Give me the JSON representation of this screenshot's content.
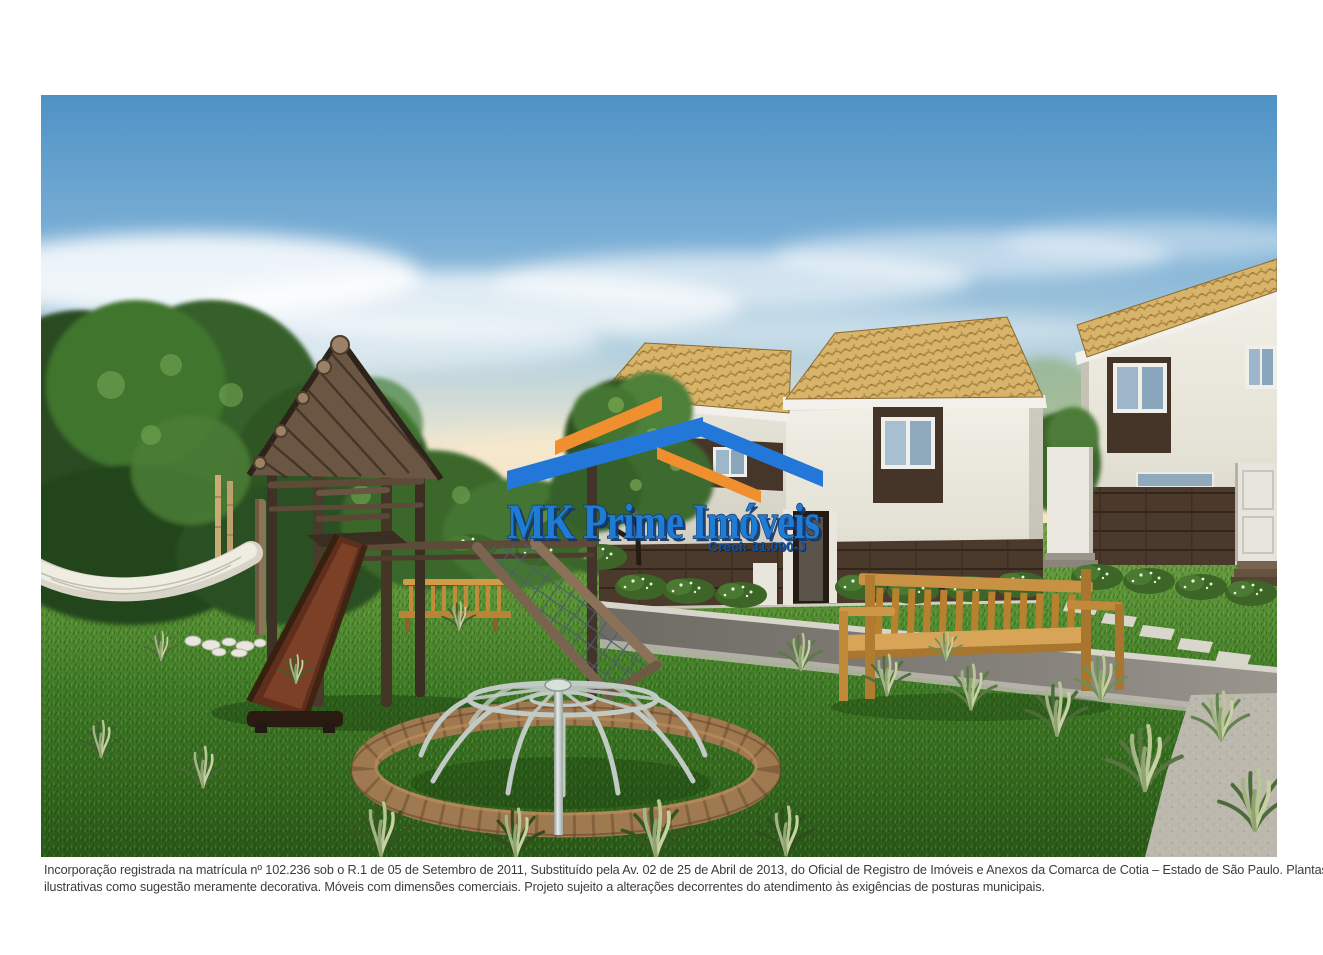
{
  "image": {
    "alt": "Perspectiva ilustrada 3D do playground do condomínio: torre de madeira com telhado de troncos, escorregador, rede de escalada, gira-gira metálico, rede de descanso, banco de madeira e casas sobrado com telhado de cerâmica ao entardecer"
  },
  "watermark": {
    "brand": "MK Prime Imóveis",
    "creci": "Creci: 31.090-J",
    "colors": {
      "roof_orange": "#EF8F2F",
      "roof_blue": "#2277D8",
      "brand_fill": "#1E7CD4",
      "brand_shadow": "#14366B",
      "creci_fill": "#1552A0"
    }
  },
  "disclaimer": {
    "line1": "Incorporação registrada na matrícula nº 102.236 sob o R.1 de 05 de Setembro de 2011, Substituído pela Av. 02 de 25 de Abril de 2013, do Oficial de Registro de Imóveis e Anexos da Comarca de Cotia – Estado de São Paulo. Plantas",
    "line2": "ilustrativas como sugestão meramente decorativa. Móveis com dimensões comerciais. Projeto sujeito a alterações decorrentes do atendimento às exigências de posturas municipais."
  },
  "palette": {
    "sky_top": "#4E92C5",
    "sky_horizon": "#F6DDB6",
    "grass_dark": "#2D5C1B",
    "grass_light": "#7AA449",
    "roof_tile": "#D8B46A",
    "house_wall": "#EFEDE4",
    "accent_brown": "#46362A",
    "bench_wood": "#C99143",
    "slide_wood": "#5F2E1D",
    "play_log": "#4A3A2C",
    "metal": "#C2CAC6",
    "road": "#76726C",
    "gravel": "#B5B1A7"
  }
}
